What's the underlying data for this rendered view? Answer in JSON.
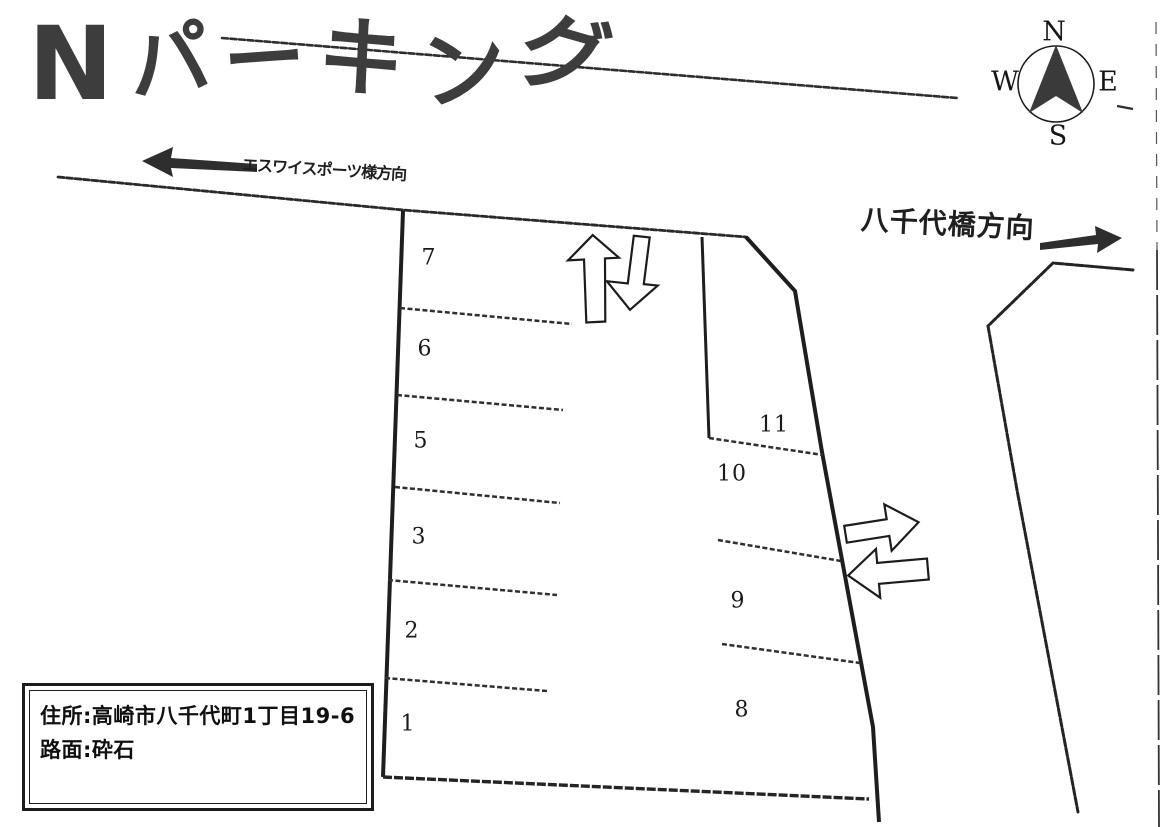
{
  "title": {
    "text": "Nパーキング"
  },
  "compass": {
    "north": "N",
    "south": "S",
    "east": "E",
    "west": "W"
  },
  "directions": {
    "west_label": "エスワイスポーツ様方向",
    "east_label": "八千代橋方向"
  },
  "parking": {
    "left_column_spaces": [
      "7",
      "6",
      "5",
      "3",
      "2",
      "1"
    ],
    "right_column_spaces": [
      "11",
      "10",
      "9",
      "8"
    ]
  },
  "info_box": {
    "address_label": "住所",
    "separator": ":",
    "address_value": "高崎市八千代町1丁目19-6",
    "surface_label": "路面",
    "surface_value": "砕石"
  },
  "colors": {
    "ink": "#2b2b2b",
    "paper": "#ffffff"
  }
}
